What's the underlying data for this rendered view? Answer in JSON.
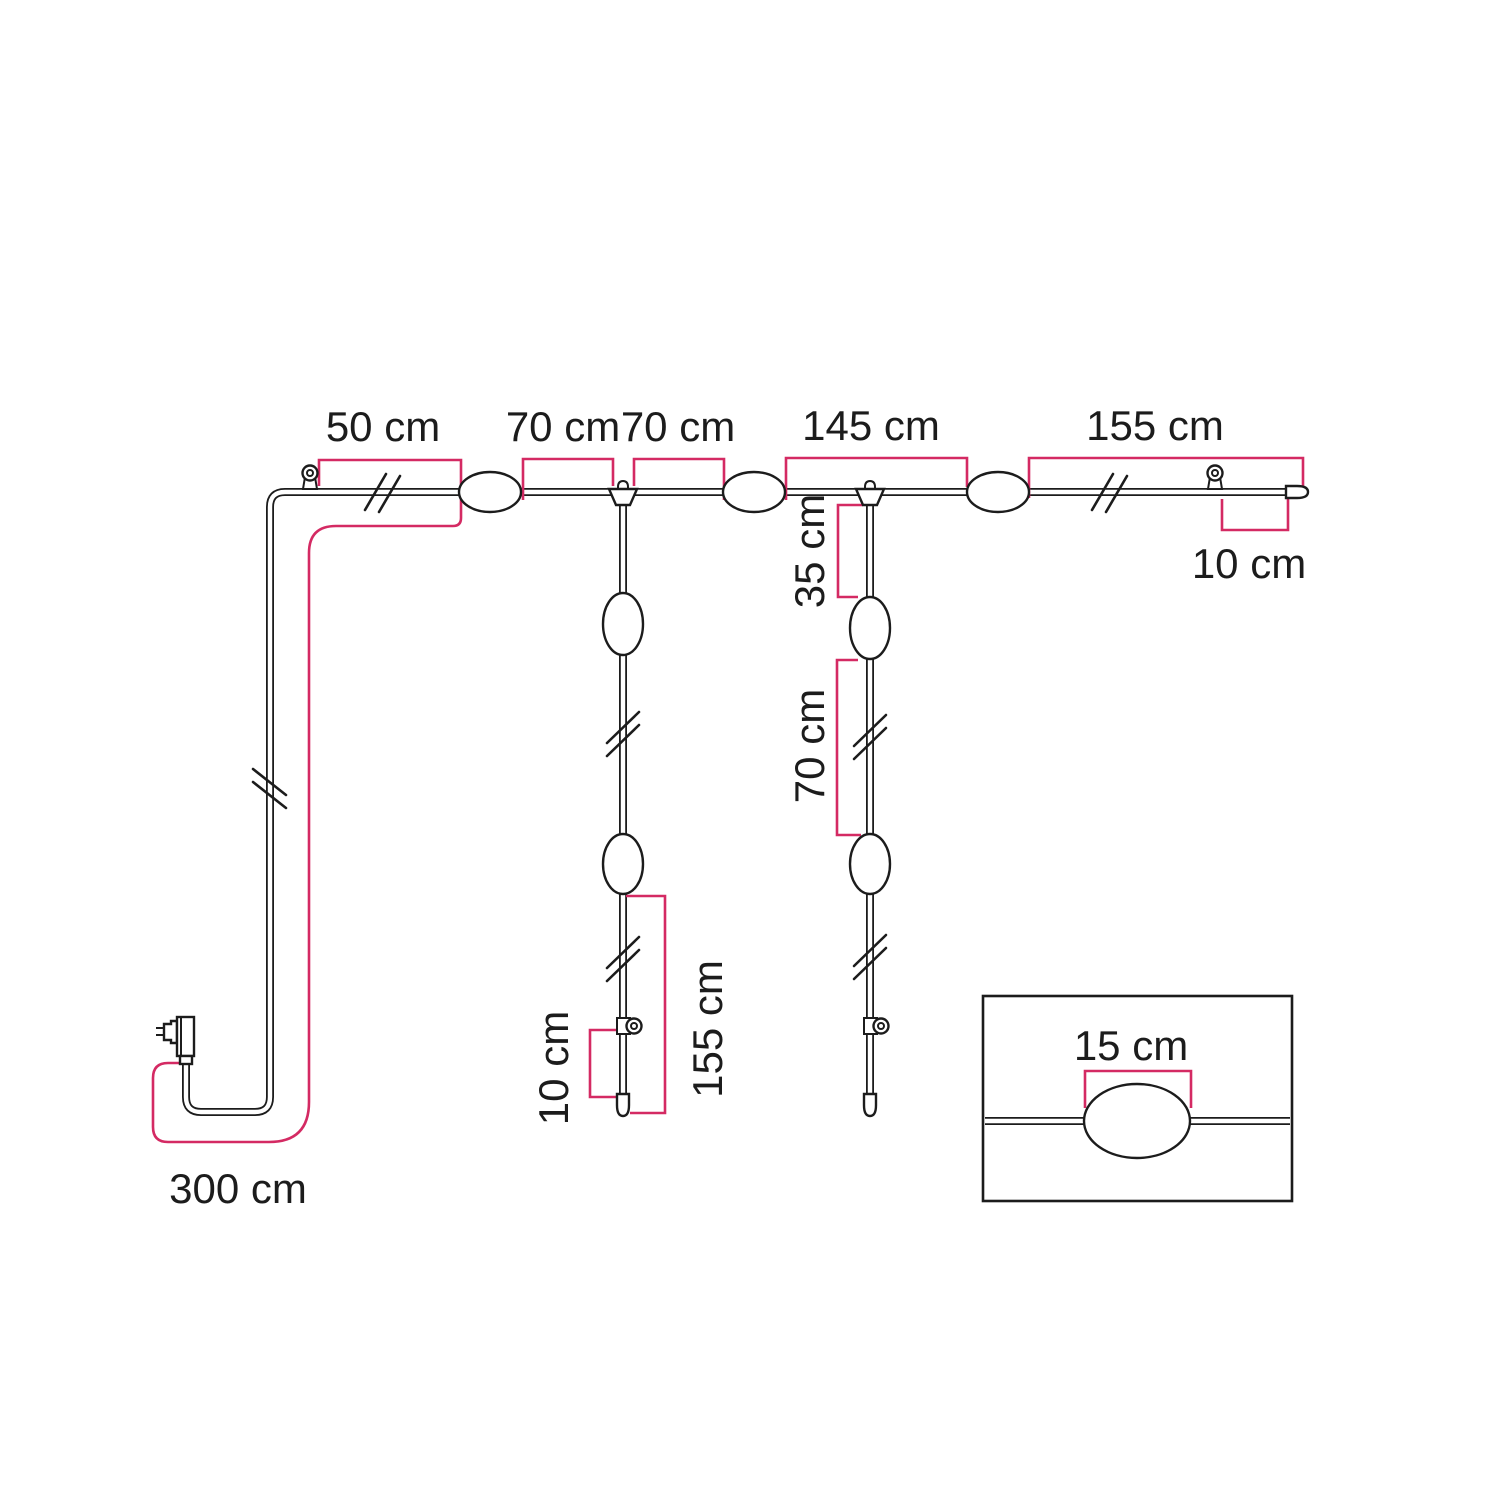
{
  "colors": {
    "line": "#1c1c1c",
    "accent": "#d42a63",
    "background": "#ffffff"
  },
  "measurements": {
    "top_run": {
      "seg_50": "50 cm",
      "seg_70_a": "70 cm",
      "seg_70_b": "70 cm",
      "seg_145": "145 cm",
      "seg_155": "155 cm",
      "end_10": "10 cm"
    },
    "left_drop": {
      "len_155": "155 cm",
      "end_10": "10 cm"
    },
    "right_drop": {
      "seg_35": "35 cm",
      "seg_70": "70 cm"
    },
    "power_lead": {
      "len_300": "300 cm"
    },
    "lamp_detail": {
      "width_15": "15 cm"
    }
  }
}
